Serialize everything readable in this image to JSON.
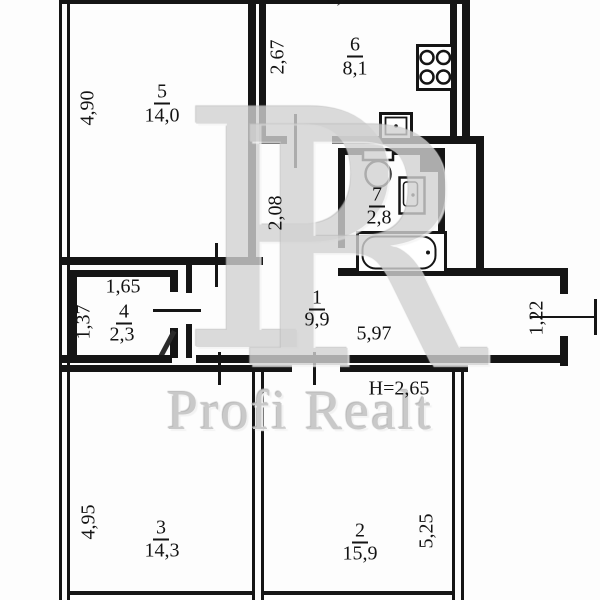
{
  "plan_title": "apartment-floor-plan",
  "ceiling_height": "H=2,65",
  "watermark": {
    "letter_p": "P",
    "letter_r": "R",
    "brand": "Profi Realt"
  },
  "rooms": {
    "r1": {
      "number": "1",
      "area": "9,9",
      "length": "5,97"
    },
    "r2": {
      "number": "2",
      "area": "15,9",
      "depth": "5,25"
    },
    "r3": {
      "number": "3",
      "area": "14,3",
      "depth": "4,95"
    },
    "r4": {
      "number": "4",
      "area": "2,3",
      "width": "1,65",
      "depth": "1,37"
    },
    "r5": {
      "number": "5",
      "area": "14,0",
      "depth": "4,90"
    },
    "r6": {
      "number": "6",
      "area": "8,1",
      "depth": "2,67",
      "width_top": "3,12"
    },
    "r7": {
      "number": "7",
      "area": "2,8"
    },
    "corridor": {
      "depth": "2,08"
    },
    "entry": {
      "width": "1,22"
    }
  },
  "icons": [
    "stove-icon",
    "kitchen-sink-icon",
    "toilet-icon",
    "water-heater-icon",
    "bathtub-icon"
  ],
  "colors": {
    "wall": "#151515",
    "text": "#141414",
    "watermark": "#cccccc",
    "background": "#fdfdfd"
  }
}
